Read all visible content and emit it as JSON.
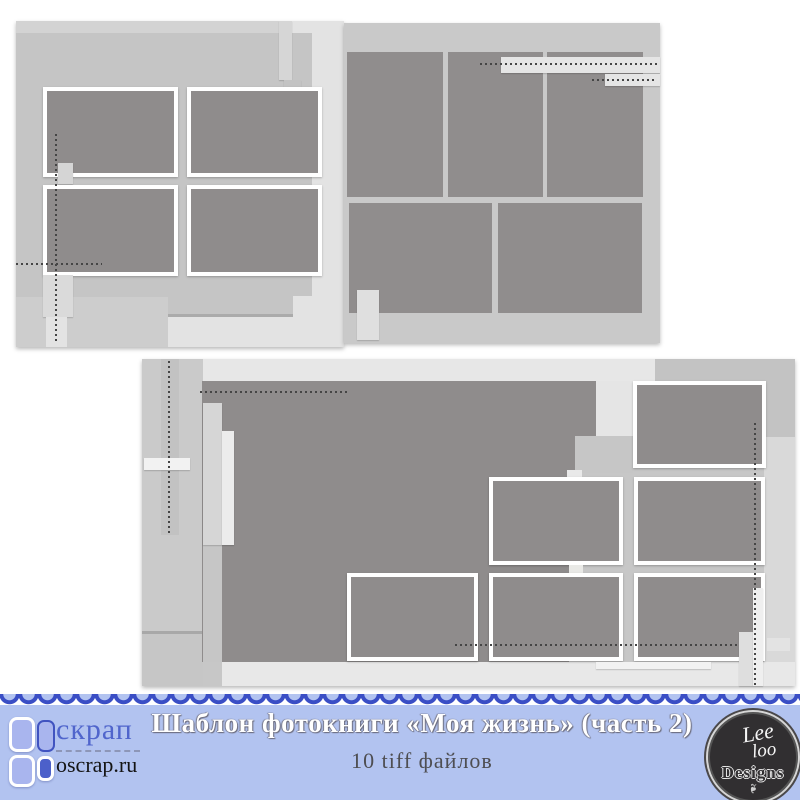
{
  "banner": {
    "title": "Шаблон фотокниги «Моя жизнь» (часть 2)",
    "subtitle": "10 tiff файлов",
    "bg_color": "#b2c3f0",
    "scallop_color": "#3a4ec5",
    "title_color": "#ffffff",
    "subtitle_color": "#4e4e52",
    "left_logo": {
      "brand": "скрап",
      "site": "oscrap.ru",
      "accent_blue": "#4c60ca",
      "light_blue": "#a9b5ee",
      "brand_text_color": "#5065cc"
    },
    "right_logo": {
      "line1": "Lee",
      "line2": "loo",
      "line3": "Designs",
      "leaf_icon": "❧",
      "bg_color": "#312f31"
    }
  },
  "previews": {
    "photo_fill_color": "#8f8c8c",
    "paper_gray": "#c6c6c6",
    "top_spread": {
      "left_page_framed_slots": 4,
      "right_page_plain_slots": 5
    },
    "bottom_template": {
      "framed_slots": 6,
      "large_blocks": 1
    }
  }
}
